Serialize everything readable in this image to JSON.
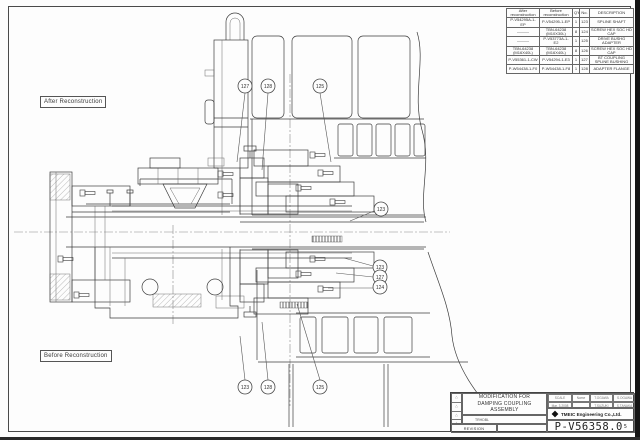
{
  "drawing_labels": {
    "after": "After Reconstruction",
    "before": "Before Reconstruction"
  },
  "parts_table": {
    "col_headers": {
      "after": "After reconstruction",
      "before": "Before reconstruction",
      "qty": "Q'ty",
      "item": "No.",
      "desc": "DESCRIPTION"
    },
    "rows": [
      {
        "after": "P-V54295A-1-EP",
        "before": "P-V54295-1-EP",
        "qty": "1",
        "item": "123",
        "desc": "SPLINE SHAFT"
      },
      {
        "after": "———",
        "before": "TBN-64238 (M10X30L)",
        "qty": "8",
        "item": "124",
        "desc": "SCREW HEX SOC HD CAP"
      },
      {
        "after": "———",
        "before": "P-V53773A-1-E2",
        "qty": "1",
        "item": "125",
        "desc": "DRIVE BUSHG ADAPTER"
      },
      {
        "after": "TBN-64238 (M16X40L)",
        "before": "TBN-64238 (M16X40L)",
        "qty": "8",
        "item": "126",
        "desc": "SCREW HEX SOC HD CAP"
      },
      {
        "after": "P-V55361-1-CW",
        "before": "P-V54294-1-E3",
        "qty": "1",
        "item": "127",
        "desc": "BT COUPLING SPLINE BUSHING"
      },
      {
        "after": "P-W54438-1-F0",
        "before": "P-W54438-1-F8",
        "qty": "1",
        "item": "128",
        "desc": "ADAPTER FLANGE"
      }
    ]
  },
  "balloons": [
    "127",
    "128",
    "125",
    "123",
    "123",
    "127",
    "124",
    "123",
    "128",
    "125"
  ],
  "title_block": {
    "title_line1": "MODIFICATION FOR",
    "title_line2": "DAMPING COUPLING ASSEMBLY",
    "ref_code": "TRHDBL",
    "revision_label": "REVISION",
    "company": "TMEIC Engineering Co.,Ltd.",
    "drawing_number": "P-V56358.0",
    "drawing_number_rev": "5",
    "info_cells": {
      "r1c1": "SCALE",
      "r1c2": "Name",
      "r1c3": "T.OGAWA",
      "r1c4": "S.OGAWA",
      "r2c1": "Mar. 3.2008",
      "r2c2": "",
      "r2c3": "T.SUZUKI",
      "r2c4": "S.TANAKA"
    },
    "colors": {
      "line": "#3d3d3d",
      "paper": "#fdfdfd"
    }
  }
}
